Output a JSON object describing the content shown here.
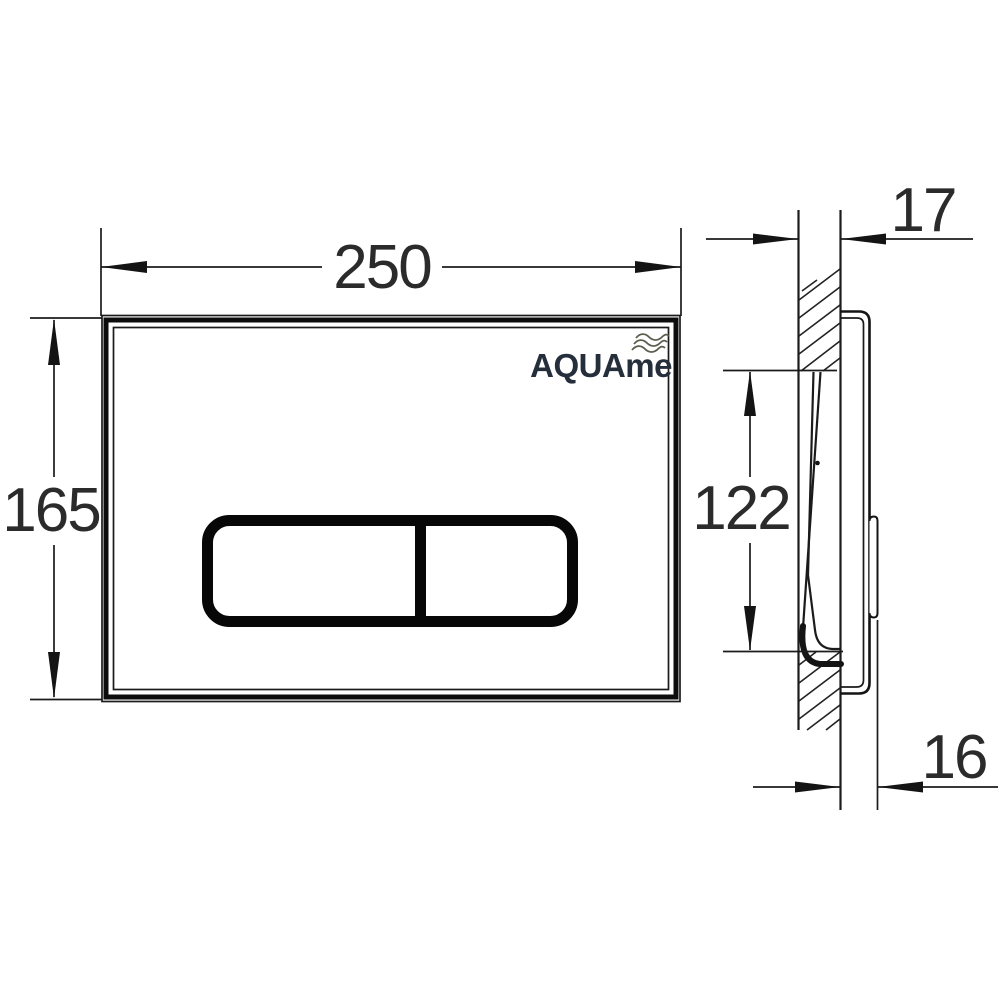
{
  "document": {
    "type": "technical-drawing",
    "subject": "wall-mounted toilet flush plate, front view and side section view"
  },
  "logo": {
    "text": "AQUAme",
    "icon": "waves-icon"
  },
  "dimensions": {
    "plate_width": "250",
    "plate_height": "165",
    "wall_inset_depth": "17",
    "cutout_height": "122",
    "protrusion_depth": "16"
  },
  "colors": {
    "background": "#ffffff",
    "line": "#1b1b1b",
    "dimension_text": "#2b2b2b",
    "logo_text": "#242f3b",
    "logo_waves": "#5c5f4e"
  }
}
